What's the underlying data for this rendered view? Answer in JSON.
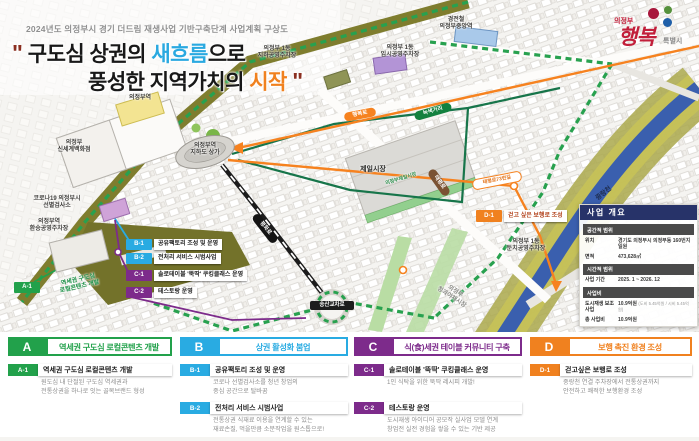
{
  "header": {
    "subtitle": "2024년도 의정부시 경기 더드림 재생사업 기반구축단계 사업계획 구상도",
    "quote_open": "\"",
    "quote_close": "\"",
    "t1a": "구도심 상권의 ",
    "t1b": "새흐름",
    "t1c": "으로",
    "t2a": "풍성한 지역가치의 ",
    "t2b": "시작",
    "logo": {
      "city": "의정부",
      "brand": "행복",
      "suffix": "특별시"
    }
  },
  "colors": {
    "program_a_green": "#22a14b",
    "program_b_blue": "#29abe2",
    "program_c_purple": "#7d2b8b",
    "program_d_orange": "#f0811f",
    "sidebar_navy": "#273369",
    "boundary_green": "#28a14f",
    "river_blue": "#3a5fae",
    "title_accent_blue": "#2aa9e0",
    "title_accent_orange": "#f0811f"
  },
  "map": {
    "places": {
      "station": "의정부역",
      "dept_store": "의정부\n신세계백화점",
      "covid_center": "코로나19 의정부시\n선별검사소",
      "transfer_parking": "의정부역\n환승공영주차장",
      "underground_mall": "의정부역\n지하도 상가",
      "parking_underground": "의정부 1동\n지하공영주차장",
      "parking_temp": "의정부 1동\n임시공영주차장",
      "lrt_station": "경전철\n의정부중앙역",
      "jeil_market": "제일시장",
      "jeil_market_street": "의정부제일시장",
      "river": "중랑천",
      "riverside_parking": "의정부 1동\n둔치공영주차장",
      "produce_market": "의정부\n청과야채시장"
    },
    "roads": {
      "haengbok": "행복로",
      "green_street": "녹색거리",
      "taepyeong": "태평로",
      "taepyeong_gil": "태평로73번길",
      "pyeonghwa": "평화로",
      "intersection": "송산교차로"
    },
    "callouts": {
      "a1": {
        "code": "A-1",
        "label": "역세권 구도심\n로컬콘텐츠 개발"
      },
      "b1": {
        "code": "B-1",
        "label": "공유팩토리 조성 및 운영"
      },
      "b2": {
        "code": "B-2",
        "label": "전처리 서비스 시범사업"
      },
      "c1": {
        "code": "C-1",
        "label": "솔로테이블 '뚝딱' 쿠킹클래스 운영"
      },
      "c2": {
        "code": "C-2",
        "label": "테스토랑 운영"
      },
      "d1": {
        "code": "D-1",
        "label": "걷고 싶은 보행로 조성"
      }
    }
  },
  "sidebar": {
    "title": "사업 개요",
    "sections": [
      {
        "heading": "공간적 범위",
        "rows": [
          {
            "label": "위치",
            "value": "경기도 의정부시 의정부동 160번지 일원"
          },
          {
            "label": "면적",
            "value": "473,628㎡"
          }
        ]
      },
      {
        "heading": "시간적 범위",
        "rows": [
          {
            "label": "사업 기간",
            "value": "2025. 1 ~ 2026. 12"
          }
        ]
      },
      {
        "heading": "사업비",
        "rows": [
          {
            "label": "도시재생 보조사업",
            "value": "10.9억원",
            "note": "(도비 5.45억원 / 시비 5.45억원)"
          },
          {
            "label": "총 사업비",
            "value": "10.9억원"
          }
        ]
      }
    ]
  },
  "programs": [
    {
      "code": "A",
      "title": "역세권 구도심 로컬콘텐츠 개발",
      "items": [
        {
          "code": "A-1",
          "title": "역세권 구도심 로컬콘텐츠 개발",
          "desc": "원도심 내 단절된 구도심 역세권과\n전통상권을 하나로 잇는 골목브랜드 형성"
        }
      ]
    },
    {
      "code": "B",
      "title": "상권 활성화 붐업",
      "items": [
        {
          "code": "B-1",
          "title": "공유팩토리 조성 및 운영",
          "desc": "코로나 선별검사소를 청년 창업의\n중심 공간으로 탈바꿈"
        },
        {
          "code": "B-2",
          "title": "전처리 서비스 시범사업",
          "desc": "전통상권 식재료 이용을 연계할 수 있는\n재료손질, 먹을만큼 소분작업을 원스톱으로!"
        }
      ]
    },
    {
      "code": "C",
      "title": "식(食)세권 테이블 커뮤니티 구축",
      "items": [
        {
          "code": "C-1",
          "title": "솔로테이블 '뚝딱' 쿠킹클래스 운영",
          "desc": "1인 식탁을 위한 뚝딱 레시피 개발!"
        },
        {
          "code": "C-2",
          "title": "테스토랑 운영",
          "desc": "도시재생 아이디어 공모작 실사업 모델 연계\n창업전 실전 경험을 쌓을 수 있는 기반 제공"
        }
      ]
    },
    {
      "code": "D",
      "title": "보행 촉진 환경 조성",
      "items": [
        {
          "code": "D-1",
          "title": "걷고싶은 보행로 조성",
          "desc": "중랑천 연결 주차장에서 전통상권까지\n안전하고 쾌적한 보행환경 조성"
        }
      ]
    }
  ]
}
